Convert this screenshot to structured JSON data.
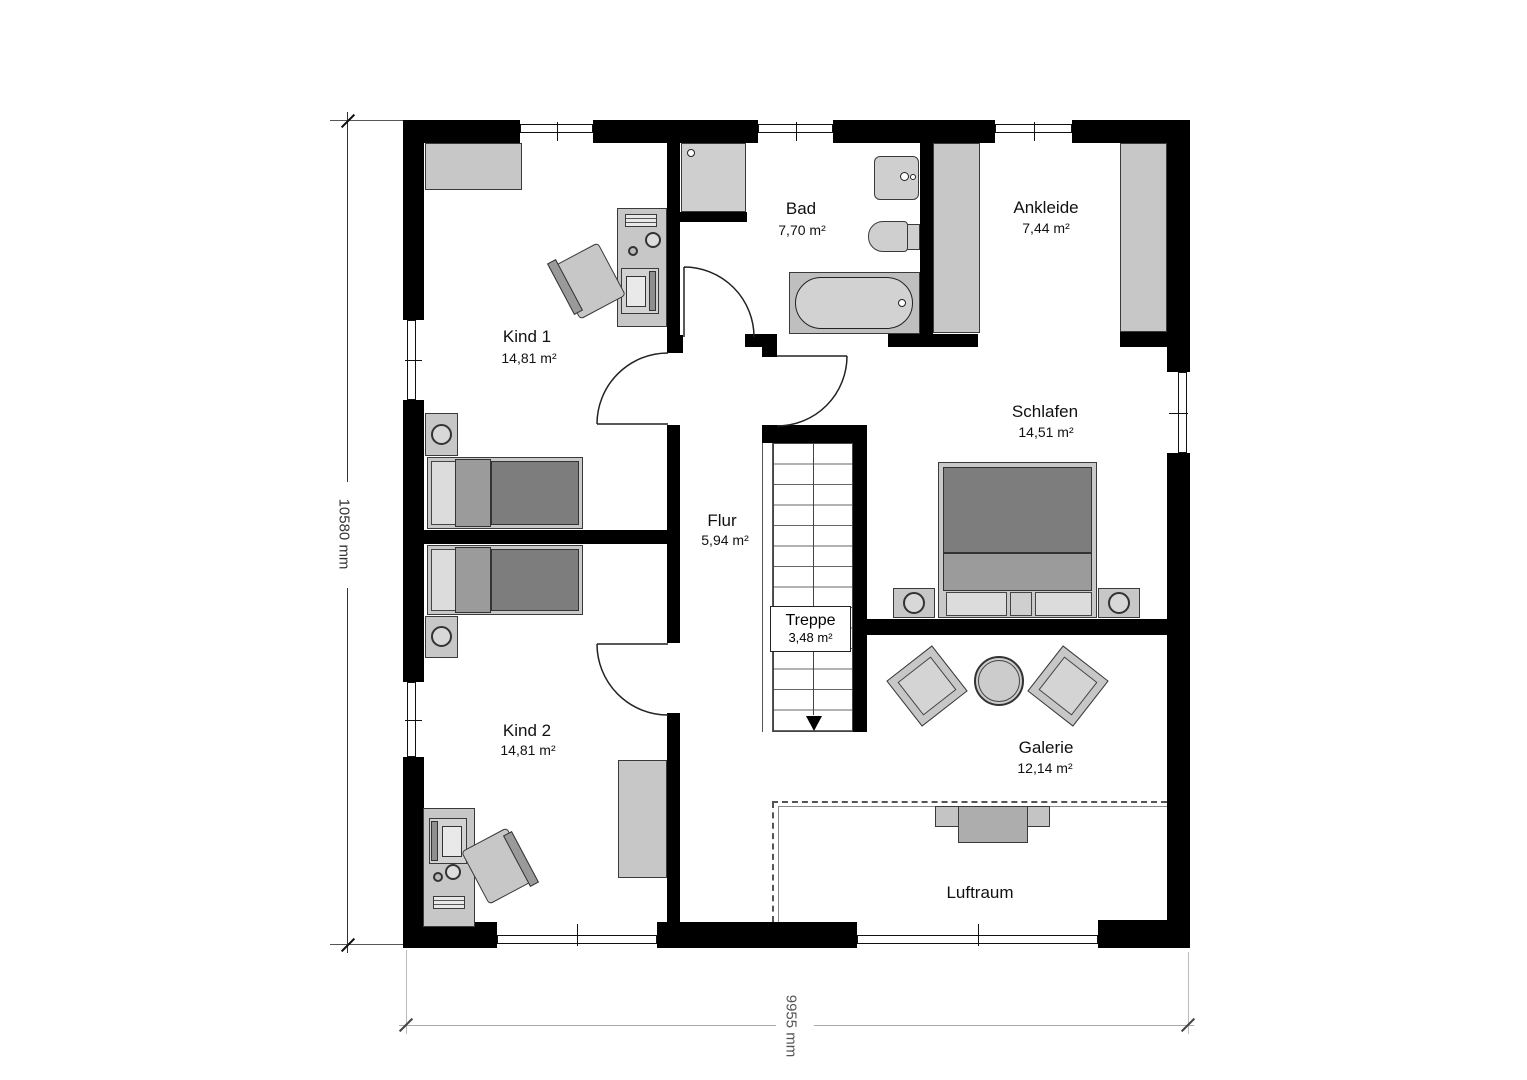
{
  "drawing": {
    "type": "floor-plan-upper-storey",
    "dimensions": {
      "left": "10580 mm",
      "bottom": "9955 mm"
    },
    "colors": {
      "wall": "#000000",
      "furniture_fill": "#c7c7c7",
      "furniture_border": "#3a3a3a",
      "bed_blanket": "#7d7d7d",
      "bed_band": "#9b9b9b",
      "pillow": "#dcdcdc",
      "tub_fill": "#d2d2d2",
      "dashed_void_line": "#555555",
      "dimension_text": "#444444"
    },
    "rooms": [
      {
        "id": "kind1",
        "name": "Kind 1",
        "area": "14,81 m²"
      },
      {
        "id": "bad",
        "name": "Bad",
        "area": "7,70 m²"
      },
      {
        "id": "ankleide",
        "name": "Ankleide",
        "area": "7,44 m²"
      },
      {
        "id": "schlafen",
        "name": "Schlafen",
        "area": "14,51 m²"
      },
      {
        "id": "flur",
        "name": "Flur",
        "area": "5,94 m²"
      },
      {
        "id": "treppe",
        "name": "Treppe",
        "area": "3,48 m²"
      },
      {
        "id": "kind2",
        "name": "Kind 2",
        "area": "14,81 m²"
      },
      {
        "id": "galerie",
        "name": "Galerie",
        "area": "12,14 m²"
      },
      {
        "id": "luftraum",
        "name": "Luftraum",
        "area": ""
      }
    ]
  }
}
